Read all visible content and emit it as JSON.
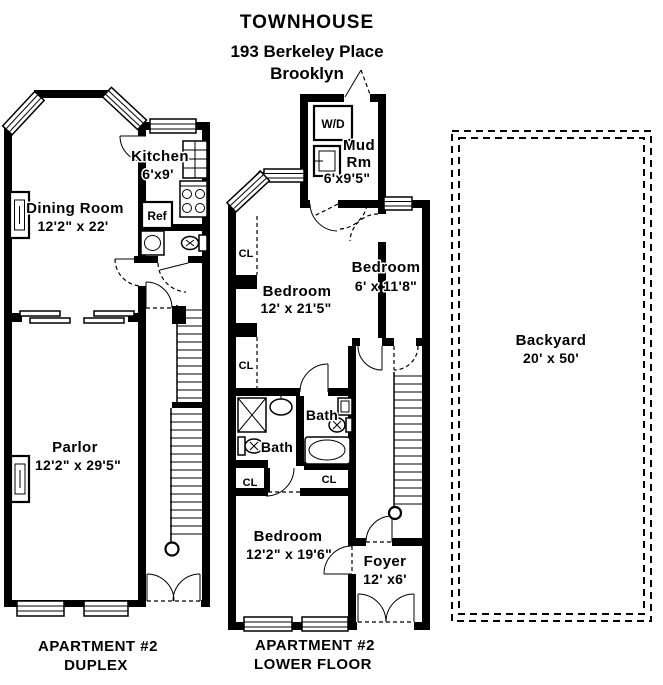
{
  "header": {
    "building_type": "TOWNHOUSE",
    "address": "193 Berkeley Place",
    "city": "Brooklyn"
  },
  "duplex_plan": {
    "caption_line1": "APARTMENT #2",
    "caption_line2": "DUPLEX",
    "kitchen_name": "Kitchen",
    "kitchen_dims": "6'x9'",
    "ref_label": "Ref",
    "dining_name": "Dining Room",
    "dining_dims": "12'2\" x 22'",
    "parlor_name": "Parlor",
    "parlor_dims": "12'2\" x 29'5\""
  },
  "lower_plan": {
    "caption_line1": "APARTMENT #2",
    "caption_line2": "LOWER FLOOR",
    "wd_label": "W/D",
    "mud_name_line1": "Mud",
    "mud_name_line2": "Rm",
    "mud_dims": "6'x9'5\"",
    "bedroom1_name": "Bedroom",
    "bedroom1_dims": "12' x 21'5\"",
    "bedroom2_name": "Bedroom",
    "bedroom2_dims": "6' x 11'8\"",
    "bath1_label": "Bath",
    "bath2_label": "Bath",
    "closet1": "CL",
    "closet2": "CL",
    "closet3": "CL",
    "closet4": "CL",
    "bedroom3_name": "Bedroom",
    "bedroom3_dims": "12'2\" x 19'6\"",
    "foyer_name": "Foyer",
    "foyer_dims": "12' x6'"
  },
  "backyard": {
    "name": "Backyard",
    "dims": "20' x 50'"
  },
  "colors": {
    "wall": "#000000",
    "background": "#ffffff"
  }
}
